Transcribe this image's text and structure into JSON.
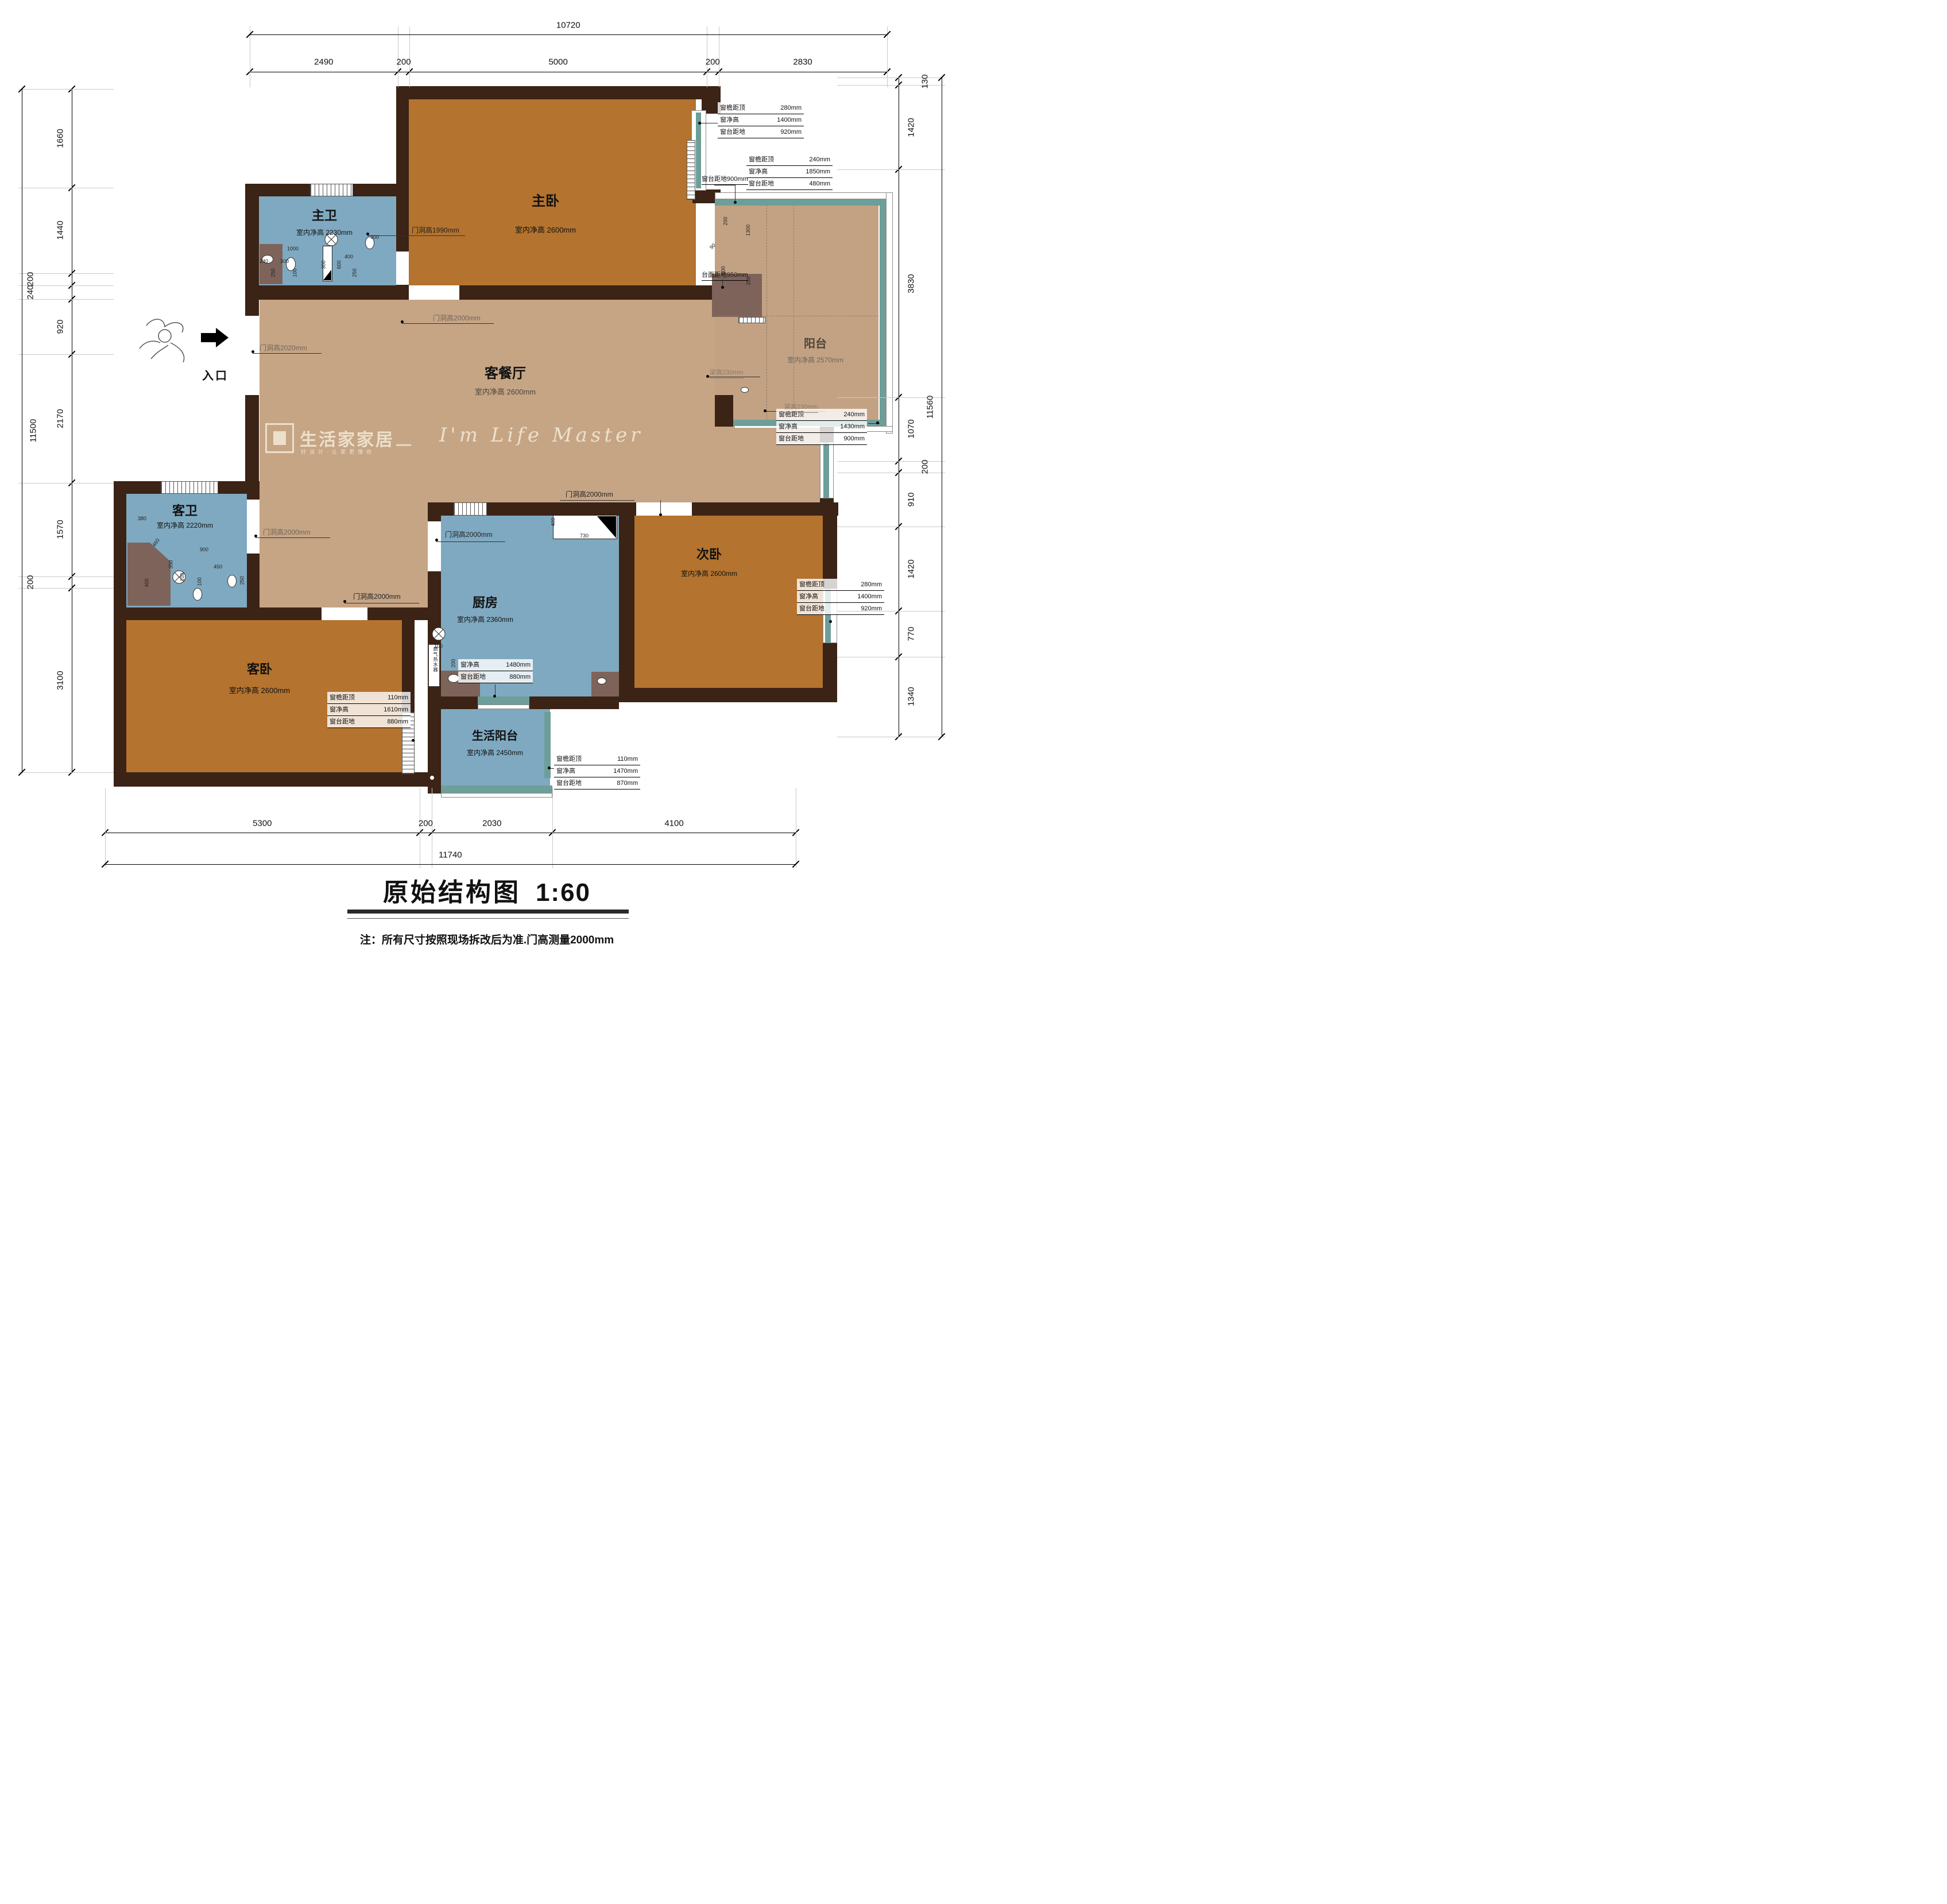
{
  "meta": {
    "title": "原始结构图",
    "scale_label": "1:60",
    "note": "注：所有尺寸按照现场拆改后为准.门高测量2000mm"
  },
  "watermark": {
    "brand": "生活家家居",
    "tagline": "好设计·让家更懂你",
    "dash": "—",
    "script": "I'm Life Master"
  },
  "entrance": {
    "label": "入口"
  },
  "rooms": {
    "master_bedroom": {
      "name": "主卧",
      "height": "室内净高 2600mm"
    },
    "master_bath": {
      "name": "主卫",
      "height": "室内净高 2230mm"
    },
    "living_dining": {
      "name": "客餐厅",
      "height": "室内净高 2600mm"
    },
    "balcony": {
      "name": "阳台",
      "height": "室内净高 2570mm"
    },
    "guest_bath": {
      "name": "客卫",
      "height": "室内净高 2220mm"
    },
    "guest_bedroom": {
      "name": "客卧",
      "height": "室内净高 2600mm"
    },
    "kitchen": {
      "name": "厨房",
      "height": "室内净高 2360mm"
    },
    "second_bedroom": {
      "name": "次卧",
      "height": "室内净高 2600mm"
    },
    "service_balcony": {
      "name": "生活阳台",
      "height": "室内净高 2450mm"
    }
  },
  "door_labels": {
    "master_bath": "门洞高1990mm",
    "master_bedroom": "门洞高2000mm",
    "entrance": "门洞高2020mm",
    "guest_bath": "门洞高2000mm",
    "guest_bedroom": "门洞高2000mm",
    "kitchen": "门洞高2000mm",
    "second_bedroom": "门洞高2000mm"
  },
  "annotations": {
    "window_tables": [
      {
        "id": "t1",
        "rows": [
          [
            "窗檐距顶",
            "280mm"
          ],
          [
            "窗净高",
            "1400mm"
          ],
          [
            "窗台距地",
            "920mm"
          ]
        ]
      },
      {
        "id": "t2",
        "rows": [
          [
            "窗檐距顶",
            "240mm"
          ],
          [
            "窗净高",
            "1850mm"
          ],
          [
            "窗台距地",
            "480mm"
          ]
        ]
      },
      {
        "id": "t3",
        "rows": [
          [
            "窗檐距顶",
            "240mm"
          ],
          [
            "窗净高",
            "1430mm"
          ],
          [
            "窗台距地",
            "900mm"
          ]
        ]
      },
      {
        "id": "t4",
        "rows": [
          [
            "窗檐距顶",
            "280mm"
          ],
          [
            "窗净高",
            "1400mm"
          ],
          [
            "窗台距地",
            "920mm"
          ]
        ]
      },
      {
        "id": "t5",
        "rows": [
          [
            "窗净高",
            "1480mm"
          ],
          [
            "窗台距地",
            "880mm"
          ]
        ]
      },
      {
        "id": "t6",
        "rows": [
          [
            "窗檐距顶",
            "110mm"
          ],
          [
            "窗净高",
            "1610mm"
          ],
          [
            "窗台距地",
            "880mm"
          ]
        ]
      },
      {
        "id": "t7",
        "rows": [
          [
            "窗檐距顶",
            "110mm"
          ],
          [
            "窗净高",
            "1470mm"
          ],
          [
            "窗台距地",
            "870mm"
          ]
        ]
      }
    ],
    "leaders": {
      "sill900": "窗台距地900mm",
      "counter950": "台面距地950mm",
      "beam1": "梁高230mm",
      "beam2": "梁高230mm"
    },
    "water_heater": "燃气热水器"
  },
  "dimensions": {
    "top": {
      "total": "10720",
      "segments": [
        "2490",
        "200",
        "5000",
        "200",
        "2830"
      ]
    },
    "bottom": {
      "total": "11740",
      "segments": [
        "5300",
        "200",
        "2030",
        "4100"
      ]
    },
    "left": {
      "total": "11500",
      "segments": [
        "1660",
        "1440",
        "200",
        "240",
        "920",
        "2170",
        "1570",
        "200",
        "3100"
      ]
    },
    "right": {
      "total": "11560",
      "segments": [
        "130",
        "1420",
        "3830",
        "1070",
        "200",
        "910",
        "1420",
        "770",
        "1340"
      ]
    }
  },
  "small_dims": [
    {
      "id": "sd1",
      "v": "1000"
    },
    {
      "id": "sd2",
      "v": "240"
    },
    {
      "id": "sd3",
      "v": "300"
    },
    {
      "id": "sd4",
      "v": "300"
    },
    {
      "id": "sd5",
      "v": "250"
    },
    {
      "id": "sd6",
      "v": "100"
    },
    {
      "id": "sd7",
      "v": "400"
    },
    {
      "id": "sd8",
      "v": "250"
    },
    {
      "id": "sd9",
      "v": "600"
    },
    {
      "id": "sd10",
      "v": "300"
    },
    {
      "id": "sd11",
      "v": "380"
    },
    {
      "id": "sd12",
      "v": "460"
    },
    {
      "id": "sd13",
      "v": "350"
    },
    {
      "id": "sd14",
      "v": "900"
    },
    {
      "id": "sd15",
      "v": "450"
    },
    {
      "id": "sd16",
      "v": "250"
    },
    {
      "id": "sd17",
      "v": "100"
    },
    {
      "id": "sd18",
      "v": "100"
    },
    {
      "id": "sd19",
      "v": "400"
    },
    {
      "id": "sd20",
      "v": "200"
    },
    {
      "id": "sd21",
      "v": "1300"
    },
    {
      "id": "sd22",
      "v": "500"
    },
    {
      "id": "sd23",
      "v": "200"
    },
    {
      "id": "sd24",
      "v": "90"
    },
    {
      "id": "sd25",
      "v": "400"
    },
    {
      "id": "sd26",
      "v": "730"
    },
    {
      "id": "sd27",
      "v": "100"
    },
    {
      "id": "sd28",
      "v": "200"
    }
  ]
}
